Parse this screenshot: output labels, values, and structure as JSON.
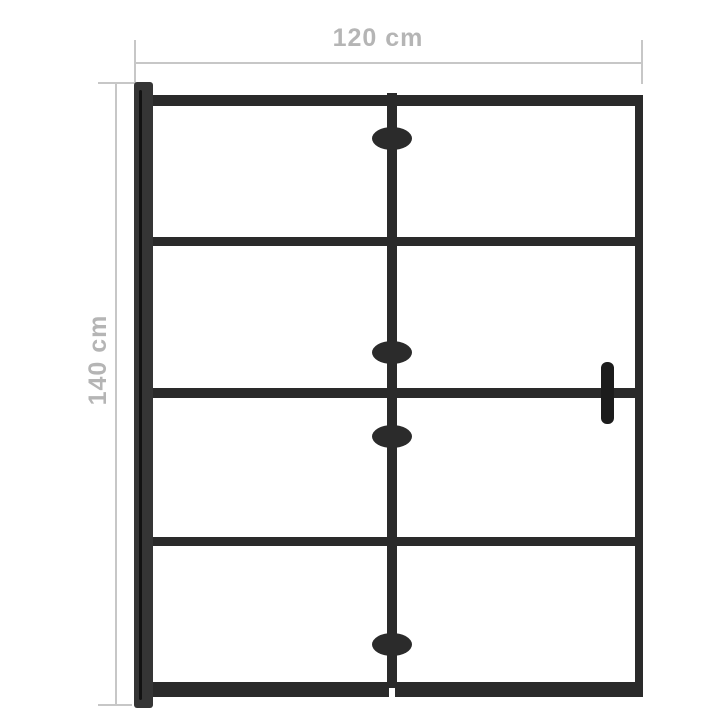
{
  "diagram": {
    "name": "folding shower screen dimension diagram",
    "width_label": "120 cm",
    "height_label": "140 cm"
  },
  "structure": {
    "panels": 2,
    "hinges": 4,
    "horizontal_bars": 5,
    "handle_side": "right",
    "wall_profile_side": "left"
  },
  "colors": {
    "background": "#ffffff",
    "frame": "#2a2a2a",
    "frame-dark": "#1c1c1c",
    "wall-profile": "#353535",
    "profile-groove": "#121212",
    "hinge": "#2b2b2b",
    "dim-line": "#c7c7c7",
    "dim-text": "#b5b5b5"
  }
}
